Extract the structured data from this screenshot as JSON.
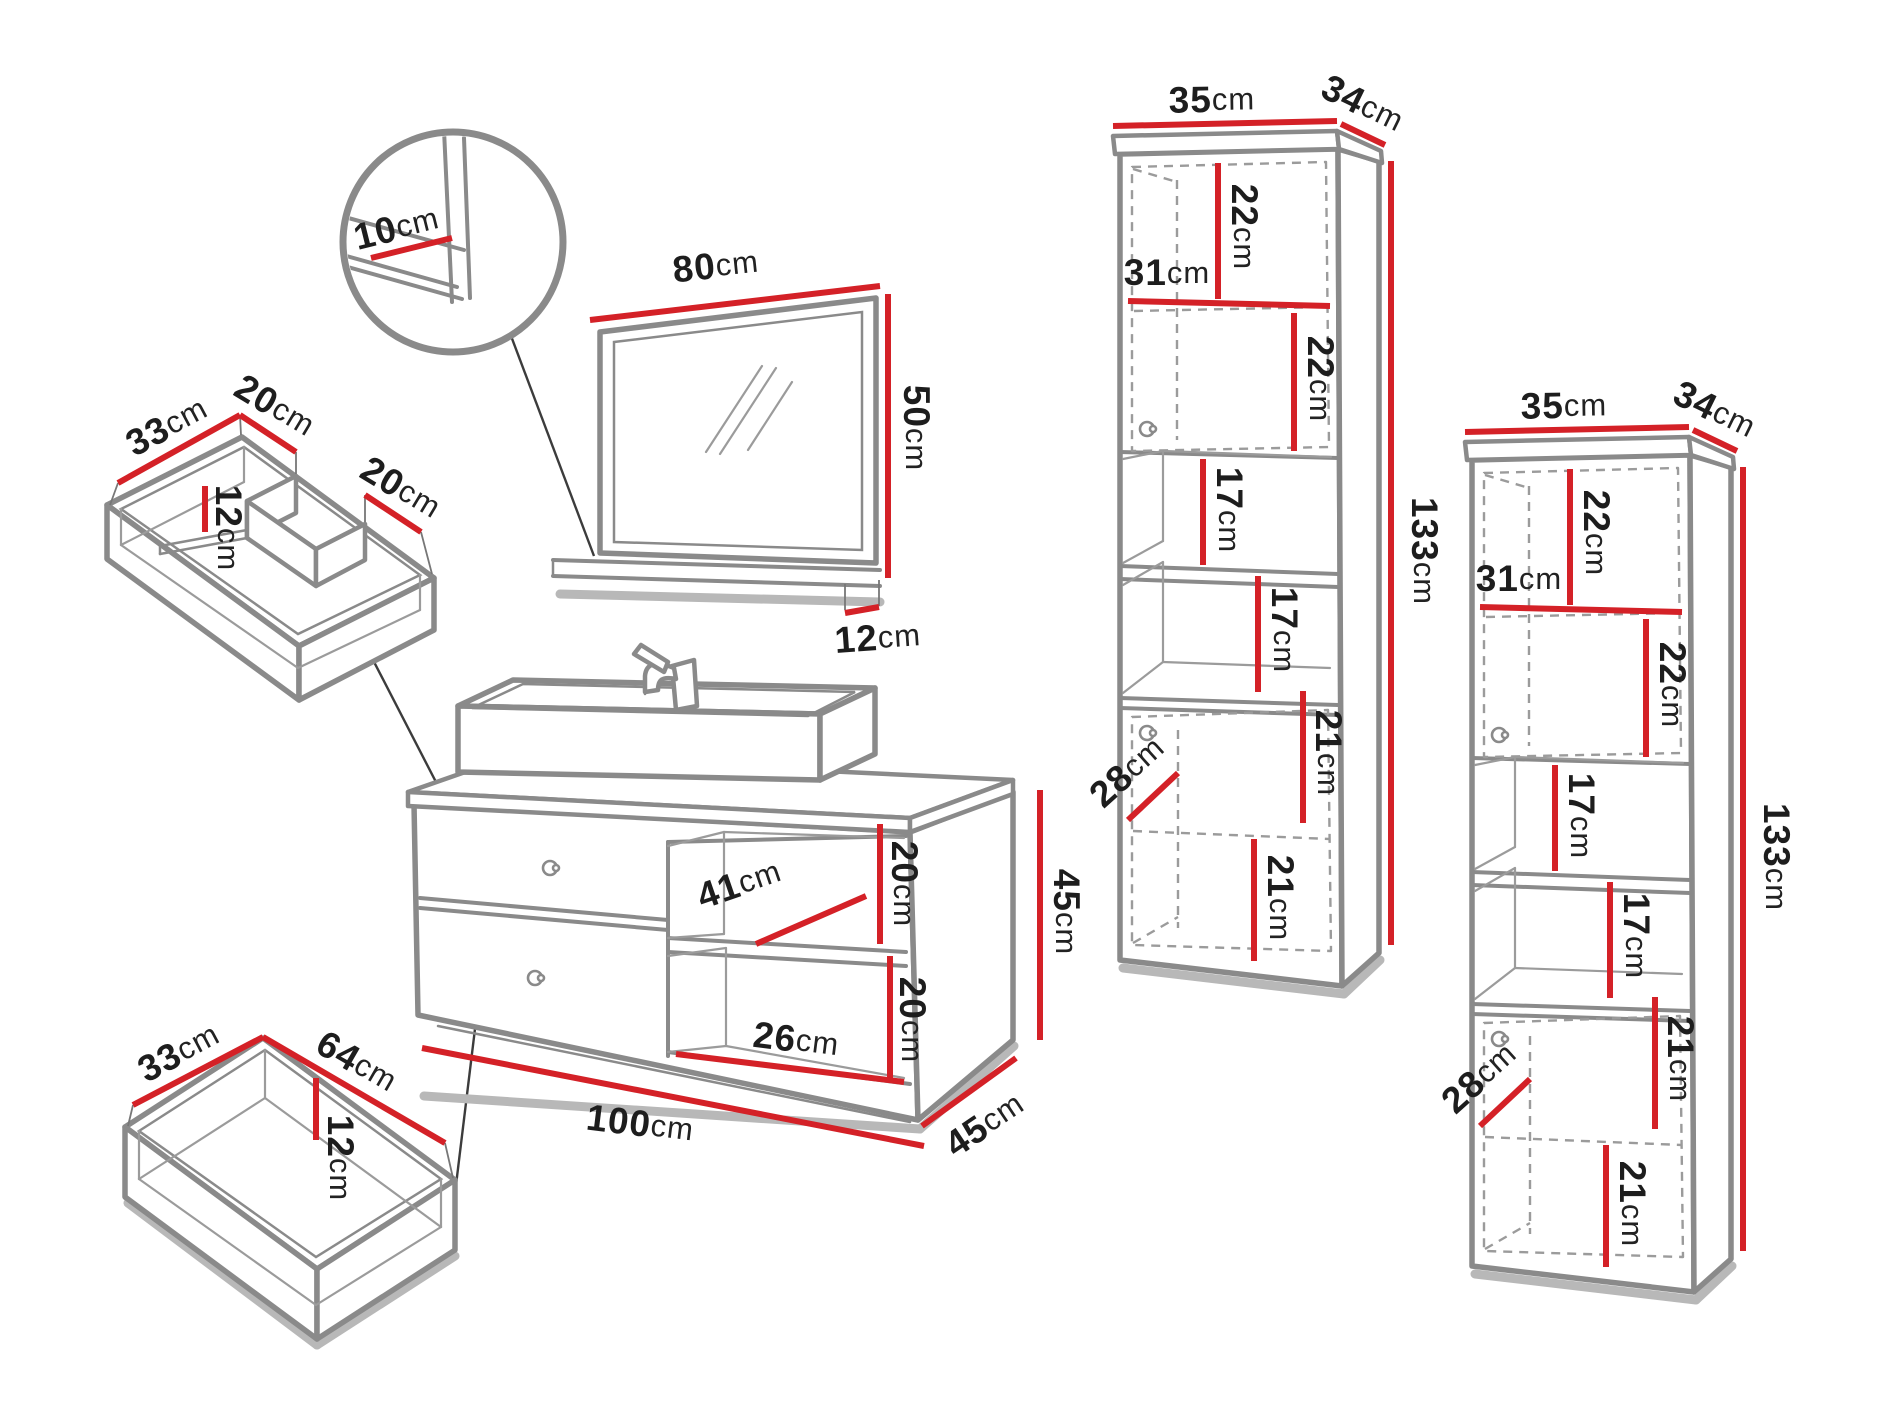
{
  "units": "cm",
  "colors": {
    "dimension_red": "#d42127",
    "outline_gray": "#8a8a8a",
    "shadow_gray": "#b8b8b8",
    "text_black": "#1d1d1d"
  },
  "detail_bubble": {
    "shelf_depth": "10"
  },
  "mirror": {
    "width": "80",
    "height": "50",
    "shelf_depth": "12"
  },
  "sink_drawer": {
    "depth": "33",
    "left_back_width": "20",
    "inner_height": "12",
    "right_back_width": "20"
  },
  "vanity": {
    "inner_depth": "41",
    "upper_niche_height": "20",
    "lower_niche_height": "20",
    "niche_width": "26",
    "width": "100",
    "depth": "45",
    "height": "45"
  },
  "bottom_drawer": {
    "depth": "33",
    "width": "64",
    "inner_height": "12"
  },
  "cabinet1": {
    "width": "35",
    "depth": "34",
    "niche1_height": "22",
    "shelf_width": "31",
    "niche2_height": "22",
    "open_shelf1_height": "17",
    "open_shelf2_height": "17",
    "door_niche1_height": "21",
    "inner_depth": "28",
    "door_niche2_height": "21",
    "height": "133"
  },
  "cabinet2": {
    "width": "35",
    "depth": "34",
    "niche1_height": "22",
    "shelf_width": "31",
    "niche2_height": "22",
    "open_shelf1_height": "17",
    "open_shelf2_height": "17",
    "door_niche1_height": "21",
    "inner_depth": "28",
    "door_niche2_height": "21",
    "height": "133"
  }
}
